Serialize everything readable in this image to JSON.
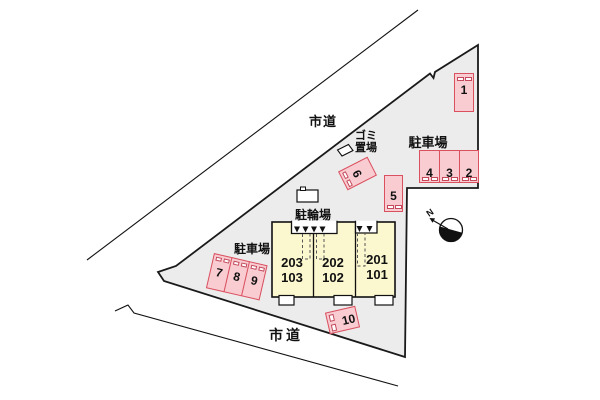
{
  "plan": {
    "road_top_label": "市道",
    "road_bottom_label": "市道",
    "parking_area_right_label": "駐車場",
    "parking_area_left_label": "駐車場",
    "bicycle_area_label": "駐輪場",
    "trash_area_label_line1": "ゴミ",
    "trash_area_label_line2": "置場",
    "compass_label": "N",
    "parking_spaces": [
      "1",
      "2",
      "3",
      "4",
      "5",
      "6",
      "7",
      "8",
      "9",
      "10"
    ],
    "building_units": [
      {
        "upper": "203",
        "lower": "103"
      },
      {
        "upper": "202",
        "lower": "102"
      },
      {
        "upper": "201",
        "lower": "101"
      }
    ],
    "colors": {
      "lot_fill": "#ececec",
      "stall_fill": "#f8ccd1",
      "stall_border": "#d9505f",
      "building_fill": "#fbf7cf",
      "line": "#111111"
    }
  }
}
